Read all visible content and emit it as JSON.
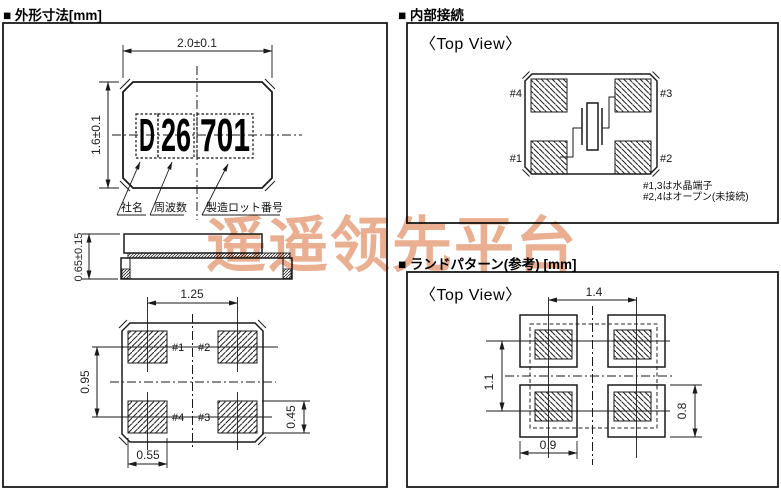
{
  "watermark": {
    "text": "遥遥领先平台",
    "color": "#e7a07c"
  },
  "colors": {
    "line": "#1a1a1a",
    "background": "#ffffff"
  },
  "outline_section": {
    "title": "■ 外形寸法[mm]",
    "marking_full": "D26701",
    "marking": {
      "company_code": "D",
      "freq_code": "26",
      "lot_code": "701"
    },
    "callouts": {
      "company": "社名",
      "frequency": "周波数",
      "lot": "製造ロット番号"
    },
    "dims": {
      "body_width": "2.0±0.1",
      "body_height": "1.6±0.1",
      "thickness": "0.65±0.15",
      "pad_pitch_x": "1.25",
      "pad_pitch_y": "0.95",
      "pad_height": "0.45",
      "pad_width": "0.55"
    },
    "pad_labels": {
      "p1": "#1",
      "p2": "#2",
      "p3": "#3",
      "p4": "#4"
    }
  },
  "connection_section": {
    "title": "■ 内部接続",
    "view_label": "〈Top View〉",
    "pad_labels": {
      "p1": "#1",
      "p2": "#2",
      "p3": "#3",
      "p4": "#4"
    },
    "notes": {
      "line1": "#1,3は水晶端子",
      "line2": "#2,4はオープン(未接続)"
    }
  },
  "land_section": {
    "title": "■ ランドパターン(参考) [mm]",
    "view_label": "〈Top View〉",
    "dims": {
      "pitch_x": "1.4",
      "pitch_y": "1.1",
      "pad_width": "0.9",
      "pad_height": "0.8"
    }
  }
}
